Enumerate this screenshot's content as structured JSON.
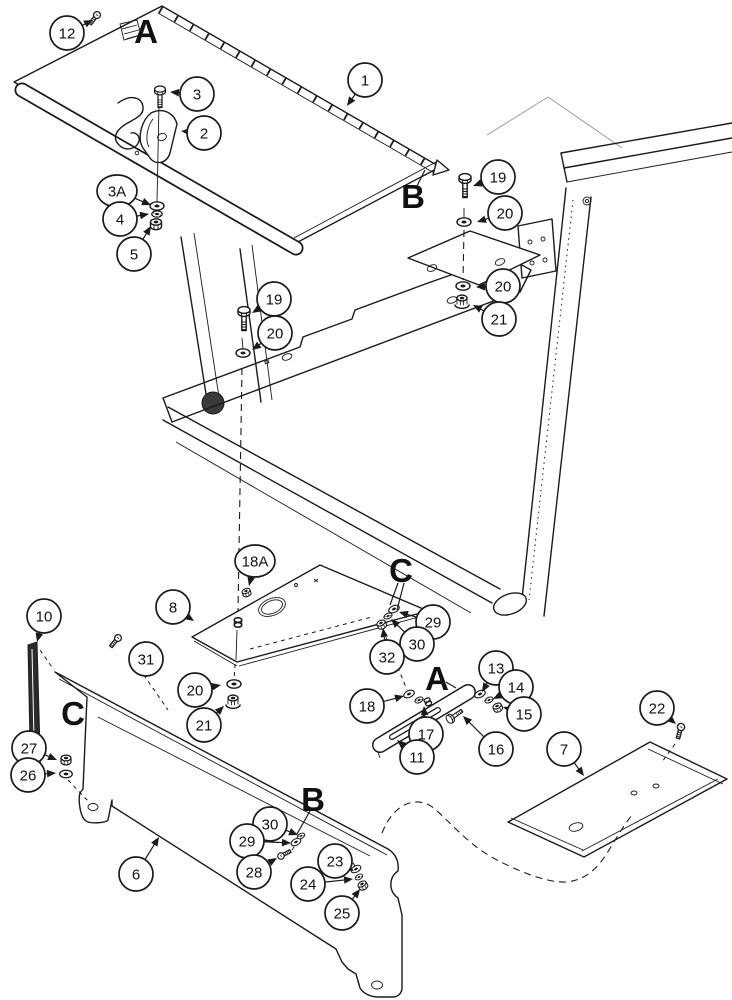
{
  "page": {
    "background": "#ffffff",
    "ink_color": "#1a1a1a",
    "faint_color": "#9b9b9b",
    "description_type": "exploded-parts-diagram"
  },
  "callouts": [
    {
      "label": "12",
      "cx": 67,
      "cy": 33,
      "tx": 93,
      "ty": 20
    },
    {
      "label": "1",
      "cx": 365,
      "cy": 80,
      "tx": 347,
      "ty": 106
    },
    {
      "label": "3",
      "cx": 197,
      "cy": 94,
      "tx": 170,
      "ty": 92
    },
    {
      "label": "2",
      "cx": 204,
      "cy": 133,
      "tx": 181,
      "ty": 131
    },
    {
      "label": "3A",
      "cx": 117,
      "cy": 191,
      "tx": 151,
      "ty": 205,
      "wide": true
    },
    {
      "label": "4",
      "cx": 120,
      "cy": 219,
      "tx": 149,
      "ty": 214
    },
    {
      "label": "5",
      "cx": 134,
      "cy": 254,
      "tx": 151,
      "ty": 226
    },
    {
      "label": "19",
      "cx": 274,
      "cy": 299,
      "tx": 252,
      "ty": 313
    },
    {
      "label": "20",
      "cx": 275,
      "cy": 333,
      "tx": 252,
      "ty": 350
    },
    {
      "label": "19",
      "cx": 498,
      "cy": 177,
      "tx": 473,
      "ty": 186
    },
    {
      "label": "20",
      "cx": 505,
      "cy": 213,
      "tx": 477,
      "ty": 222
    },
    {
      "label": "20",
      "cx": 503,
      "cy": 286,
      "tx": 476,
      "ty": 287
    },
    {
      "label": "21",
      "cx": 499,
      "cy": 319,
      "tx": 473,
      "ty": 305
    },
    {
      "label": "18A",
      "cx": 255,
      "cy": 561,
      "tx": 249,
      "ty": 586,
      "wide": true
    },
    {
      "label": "8",
      "cx": 173,
      "cy": 607,
      "tx": 194,
      "ty": 621
    },
    {
      "label": "29",
      "cx": 433,
      "cy": 622,
      "tx": 399,
      "ty": 612
    },
    {
      "label": "30",
      "cx": 417,
      "cy": 644,
      "tx": 391,
      "ty": 619
    },
    {
      "label": "32",
      "cx": 387,
      "cy": 657,
      "tx": 383,
      "ty": 628
    },
    {
      "label": "10",
      "cx": 44,
      "cy": 616,
      "tx": 37,
      "ty": 642
    },
    {
      "label": "31",
      "cx": 146,
      "cy": 659,
      "tx": 130,
      "ty": 650
    },
    {
      "label": "20",
      "cx": 195,
      "cy": 690,
      "tx": 221,
      "ty": 685
    },
    {
      "label": "21",
      "cx": 204,
      "cy": 725,
      "tx": 224,
      "ty": 706
    },
    {
      "label": "13",
      "cx": 496,
      "cy": 668,
      "tx": 482,
      "ty": 692
    },
    {
      "label": "14",
      "cx": 516,
      "cy": 687,
      "tx": 493,
      "ty": 699
    },
    {
      "label": "15",
      "cx": 524,
      "cy": 714,
      "tx": 503,
      "ty": 707
    },
    {
      "label": "18",
      "cx": 367,
      "cy": 706,
      "tx": 404,
      "ty": 696
    },
    {
      "label": "17",
      "cx": 426,
      "cy": 734,
      "tx": 424,
      "ty": 706
    },
    {
      "label": "16",
      "cx": 496,
      "cy": 749,
      "tx": 463,
      "ty": 716
    },
    {
      "label": "11",
      "cx": 417,
      "cy": 757,
      "tx": 397,
      "ty": 740
    },
    {
      "label": "22",
      "cx": 657,
      "cy": 708,
      "tx": 676,
      "ty": 724
    },
    {
      "label": "7",
      "cx": 564,
      "cy": 749,
      "tx": 584,
      "ty": 776
    },
    {
      "label": "27",
      "cx": 29,
      "cy": 748,
      "tx": 57,
      "ty": 760
    },
    {
      "label": "26",
      "cx": 28,
      "cy": 775,
      "tx": 56,
      "ty": 773
    },
    {
      "label": "6",
      "cx": 136,
      "cy": 874,
      "tx": 159,
      "ty": 837
    },
    {
      "label": "30",
      "cx": 270,
      "cy": 824,
      "tx": 298,
      "ty": 835
    },
    {
      "label": "29",
      "cx": 247,
      "cy": 841,
      "tx": 291,
      "ty": 843
    },
    {
      "label": "28",
      "cx": 254,
      "cy": 872,
      "tx": 277,
      "ty": 858
    },
    {
      "label": "23",
      "cx": 335,
      "cy": 861,
      "tx": 354,
      "ty": 871
    },
    {
      "label": "24",
      "cx": 308,
      "cy": 884,
      "tx": 353,
      "ty": 879
    },
    {
      "label": "25",
      "cx": 342,
      "cy": 913,
      "tx": 360,
      "ty": 889
    }
  ],
  "letters": [
    {
      "label": "A",
      "x": 146,
      "y": 31,
      "leaders": []
    },
    {
      "label": "B",
      "x": 413,
      "y": 196,
      "leaders": [
        [
          417,
          186,
          425,
          170
        ]
      ]
    },
    {
      "label": "C",
      "x": 401,
      "y": 570,
      "leaders": [
        [
          398,
          583,
          390,
          605
        ],
        [
          404,
          583,
          397,
          610
        ]
      ]
    },
    {
      "label": "A",
      "x": 437,
      "y": 678,
      "leaders": [
        [
          446,
          682,
          456,
          688
        ]
      ]
    },
    {
      "label": "C",
      "x": 73,
      "y": 713,
      "leaders": []
    },
    {
      "label": "B",
      "x": 313,
      "y": 799,
      "leaders": [
        [
          310,
          811,
          297,
          834
        ]
      ]
    }
  ],
  "hardware": [
    {
      "type": "screw",
      "x": 97,
      "y": 15,
      "rot": 38,
      "s": 0.9
    },
    {
      "type": "bolt",
      "x": 160,
      "y": 90,
      "rot": 0,
      "s": 0.9
    },
    {
      "type": "washer",
      "x": 157,
      "y": 206,
      "rot": 0,
      "s": 1
    },
    {
      "type": "lock",
      "x": 157,
      "y": 214,
      "rot": 0,
      "s": 0.9
    },
    {
      "type": "nut",
      "x": 156,
      "y": 222,
      "rot": 0,
      "s": 1
    },
    {
      "type": "bolt",
      "x": 244,
      "y": 311,
      "rot": 0,
      "s": 1
    },
    {
      "type": "washer",
      "x": 243,
      "y": 353,
      "rot": 0,
      "s": 1
    },
    {
      "type": "bolt",
      "x": 465,
      "y": 178,
      "rot": 0,
      "s": 1
    },
    {
      "type": "washer",
      "x": 464,
      "y": 222,
      "rot": 0,
      "s": 1
    },
    {
      "type": "washer",
      "x": 463,
      "y": 286,
      "rot": 0,
      "s": 1
    },
    {
      "type": "flange",
      "x": 462,
      "y": 298,
      "rot": 0,
      "s": 1
    },
    {
      "type": "nut",
      "x": 246,
      "y": 591,
      "rot": -20,
      "s": 0.75
    },
    {
      "type": "washer",
      "x": 394,
      "y": 609,
      "rot": -25,
      "s": 0.8
    },
    {
      "type": "lock",
      "x": 388,
      "y": 616,
      "rot": -25,
      "s": 0.75
    },
    {
      "type": "nut",
      "x": 381,
      "y": 623,
      "rot": -25,
      "s": 0.8
    },
    {
      "type": "washer",
      "x": 234,
      "y": 684,
      "rot": 0,
      "s": 1
    },
    {
      "type": "flange",
      "x": 233,
      "y": 698,
      "rot": 0,
      "s": 1
    },
    {
      "type": "screw",
      "x": 118,
      "y": 638,
      "rot": 40,
      "s": 0.9
    },
    {
      "type": "washer",
      "x": 409,
      "y": 694,
      "rot": -25,
      "s": 0.8
    },
    {
      "type": "lock",
      "x": 419,
      "y": 700,
      "rot": -25,
      "s": 0.75
    },
    {
      "type": "stud",
      "x": 427,
      "y": 700,
      "rot": -25,
      "s": 0.9
    },
    {
      "type": "bolt",
      "x": 450,
      "y": 719,
      "rot": -125,
      "s": 0.75
    },
    {
      "type": "washer",
      "x": 480,
      "y": 694,
      "rot": -25,
      "s": 0.8
    },
    {
      "type": "lock",
      "x": 489,
      "y": 700,
      "rot": -25,
      "s": 0.75
    },
    {
      "type": "nut",
      "x": 497,
      "y": 706,
      "rot": -25,
      "s": 0.8
    },
    {
      "type": "nut",
      "x": 66,
      "y": 758,
      "rot": 0,
      "s": 0.9
    },
    {
      "type": "washer",
      "x": 66,
      "y": 774,
      "rot": 0,
      "s": 0.9
    },
    {
      "type": "screw",
      "x": 281,
      "y": 856,
      "rot": -118,
      "s": 0.85
    },
    {
      "type": "washer",
      "x": 296,
      "y": 842,
      "rot": -28,
      "s": 0.75
    },
    {
      "type": "lock",
      "x": 301,
      "y": 836,
      "rot": -28,
      "s": 0.7
    },
    {
      "type": "washer",
      "x": 356,
      "y": 869,
      "rot": -30,
      "s": 0.75
    },
    {
      "type": "lock",
      "x": 359,
      "y": 877,
      "rot": -30,
      "s": 0.7
    },
    {
      "type": "nut",
      "x": 362,
      "y": 884,
      "rot": -30,
      "s": 0.8
    },
    {
      "type": "screw",
      "x": 681,
      "y": 727,
      "rot": 15,
      "s": 0.95
    },
    {
      "type": "stud",
      "x": 238,
      "y": 620,
      "rot": 0,
      "s": 1.1
    }
  ]
}
